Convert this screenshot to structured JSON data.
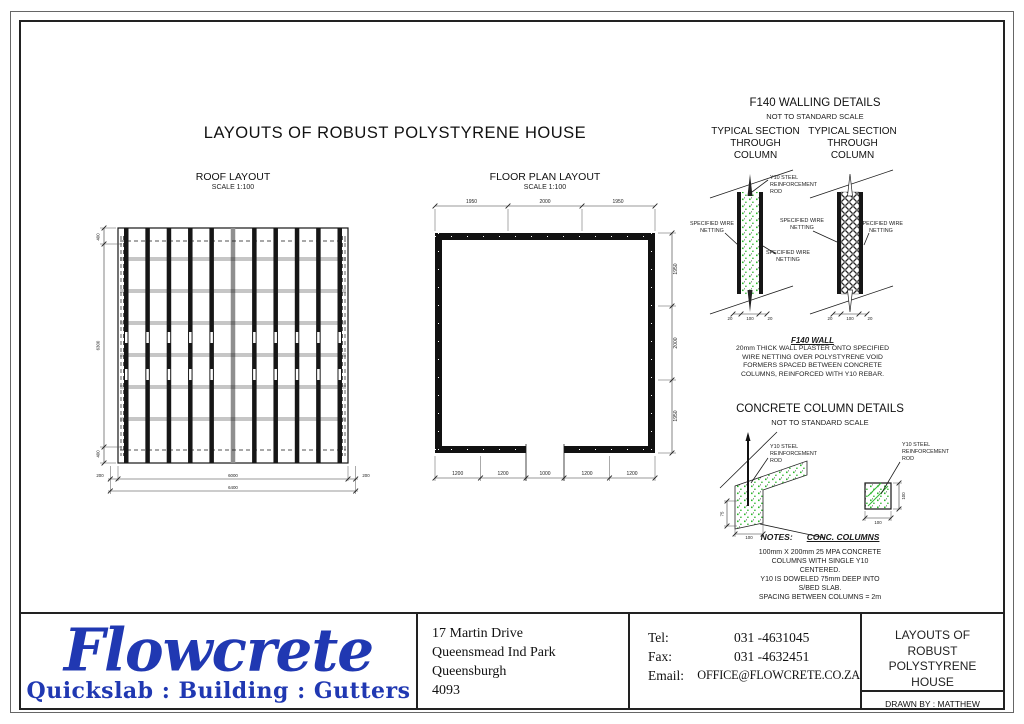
{
  "sheet": {
    "main_title": "LAYOUTS OF ROBUST POLYSTYRENE HOUSE"
  },
  "roof": {
    "title": "ROOF LAYOUT",
    "scale": "SCALE 1:100",
    "dims_left": [
      "400",
      "6300",
      "400"
    ],
    "dims_bottom": [
      "200",
      "6000",
      "200"
    ],
    "dim_total": "6400"
  },
  "floor": {
    "title": "FLOOR PLAN LAYOUT",
    "scale": "SCALE 1:100",
    "dims_top": [
      "1950",
      "2000",
      "1950"
    ],
    "dims_right": [
      "1950",
      "2000",
      "1950"
    ],
    "dims_bottom": [
      "1200",
      "1200",
      "1000",
      "1200",
      "1200"
    ]
  },
  "walling": {
    "title": "F140 WALLING DETAILS",
    "subtitle": "NOT TO STANDARD SCALE",
    "section_heading_lines": [
      "TYPICAL SECTION",
      "THROUGH",
      "COLUMN"
    ],
    "rod_label_lines": [
      "Y10 STEEL",
      "REINFORCEMENT",
      "ROD"
    ],
    "netting_label_lines": [
      "SPECIFIED WIRE",
      "NETTING"
    ],
    "section_dims": [
      "20",
      "100",
      "20"
    ],
    "note_title": "F140 WALL",
    "note_lines": [
      "20mm THICK WALL PLASTER ONTO SPECIFIED",
      "WIRE NETTING OVER POLYSTYRENE VOID",
      "FORMERS SPACED BETWEEN CONCRETE",
      "COLUMNS, REINFORCED WITH Y10 REBAR."
    ]
  },
  "column_details": {
    "title": "CONCRETE COLUMN DETAILS",
    "subtitle": "NOT TO STANDARD SCALE",
    "rod_label_lines": [
      "Y10 STEEL",
      "REINFORCEMENT",
      "ROD"
    ],
    "dims": {
      "depth": "75",
      "width": "100",
      "plan_width": "100",
      "plan_height": "100"
    }
  },
  "notes": {
    "label": "NOTES:",
    "heading": "CONC. COLUMNS",
    "lines": [
      "100mm X 200mm 25 MPA CONCRETE",
      "COLUMNS WITH SINGLE Y10",
      "CENTERED.",
      "Y10 IS DOWELED 75mm DEEP INTO",
      "S/BED SLAB.",
      "SPACING BETWEEN COLUMNS = 2m"
    ]
  },
  "title_block": {
    "logo_text": "Flowcrete",
    "logo_tagline": "Quickslab : Building : Gutters",
    "logo_color": "#2038b2",
    "address_lines": [
      "17 Martin Drive",
      "Queensmead Ind Park",
      "Queensburgh",
      "4093"
    ],
    "contact": {
      "tel_label": "Tel:",
      "tel_value": "031 -4631045",
      "fax_label": "Fax:",
      "fax_value": "031 -4632451",
      "email_label": "Email:",
      "email_value": "OFFICE@FLOWCRETE.CO.ZA"
    },
    "drawing_title_lines": [
      "LAYOUTS OF",
      "ROBUST",
      "POLYSTYRENE",
      "HOUSE"
    ],
    "drawn_by": "DRAWN BY : MATTHEW ROBINSON"
  }
}
